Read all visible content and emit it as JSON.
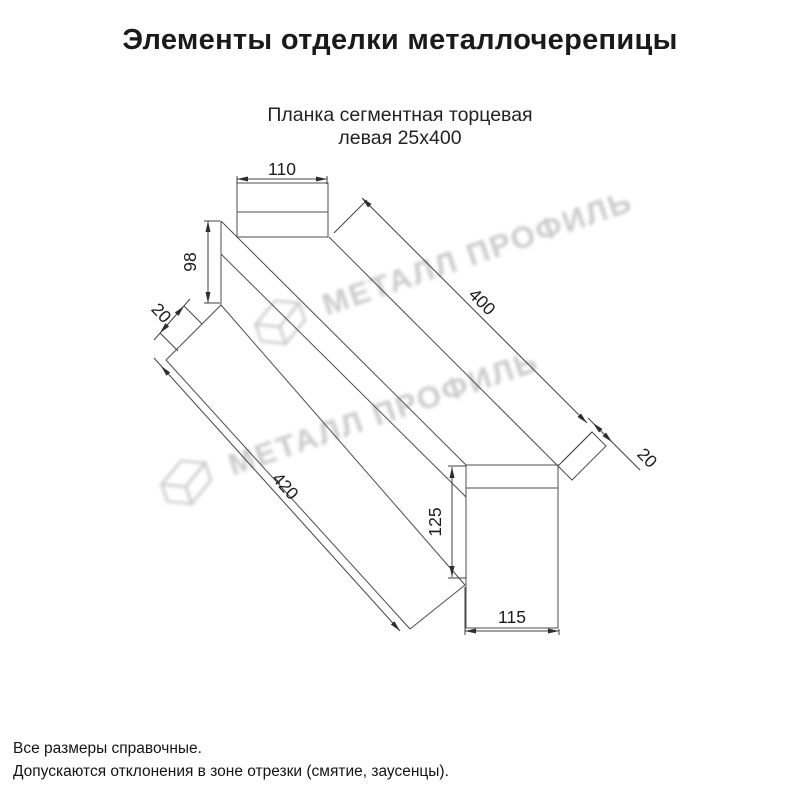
{
  "header": {
    "title": "Элементы отделки металлочерепицы"
  },
  "product": {
    "name_line1": "Планка сегментная торцевая",
    "name_line2": "левая 25х400"
  },
  "watermark": {
    "brand": "МЕТАЛЛ ПРОФИЛЬ"
  },
  "dimensions": {
    "top_flange_width": "110",
    "left_end_height": "98",
    "left_hem_width": "20",
    "top_edge_length": "400",
    "bottom_edge_length": "420",
    "right_hem_width": "20",
    "right_end_height": "125",
    "bottom_end_width": "115"
  },
  "notes": {
    "line1": "Все размеры справочные.",
    "line2": "Допускаются отклонения в зоне отрезки (смятие, заусенцы)."
  },
  "colors": {
    "background": "#ffffff",
    "line": "#4d4d4d",
    "text": "#1c1c1c",
    "watermark": "#c3c3c3"
  }
}
